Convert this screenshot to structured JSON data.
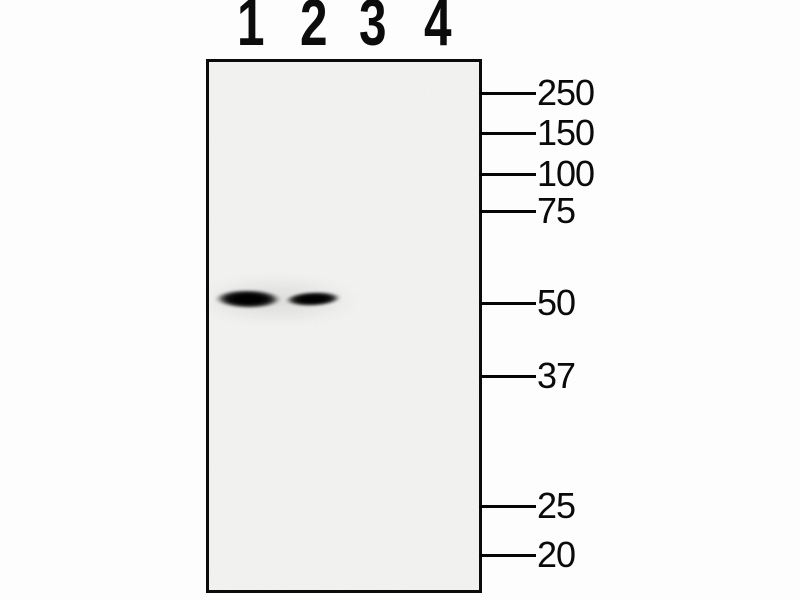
{
  "figure": {
    "kind": "western-blot",
    "lane_labels": [
      "1",
      "2",
      "3",
      "4"
    ],
    "ladder": {
      "markers": [
        "250",
        "150",
        "100",
        "75",
        "50",
        "37",
        "25",
        "20"
      ]
    },
    "bands": [
      {
        "lane": "1",
        "aligned_marker": "50"
      },
      {
        "lane": "2",
        "aligned_marker": "50"
      }
    ],
    "colors": {
      "background": "#fdfdfd",
      "panel_background": "#f6f6f5",
      "ink": "#0b0b0b"
    }
  }
}
